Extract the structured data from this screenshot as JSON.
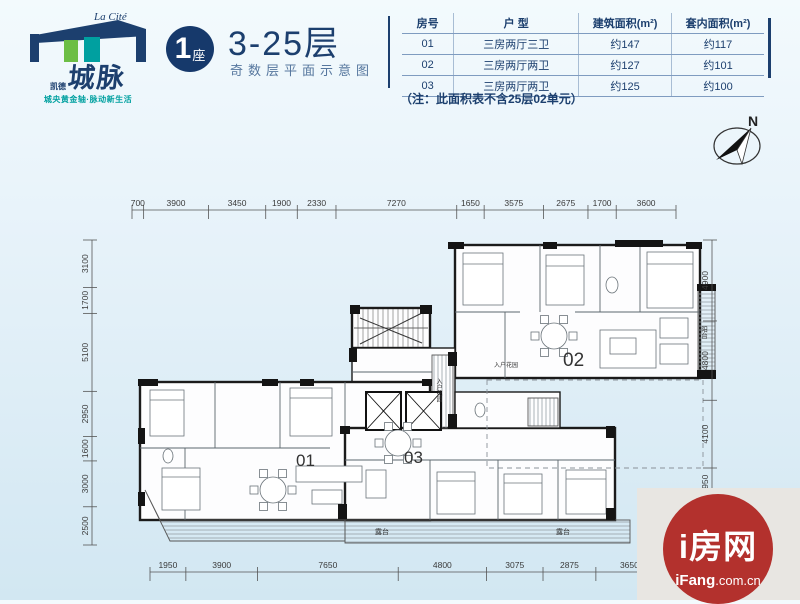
{
  "logo": {
    "brand_en": "La Cité",
    "brand_cn_small": "凯德",
    "brand_cn_big": "城脉",
    "tagline": "城央黄金轴·脉动新生活",
    "colors": {
      "navy": "#1c3f6e",
      "green": "#6cbe45",
      "teal": "#00a0a0"
    }
  },
  "header": {
    "block_number": "1",
    "block_suffix": "座",
    "title": "3-25层",
    "subtitle": "奇数层平面示意图"
  },
  "area_table": {
    "headers": [
      "房号",
      "户  型",
      "建筑面积(m²)",
      "套内面积(m²)"
    ],
    "rows": [
      [
        "01",
        "三房两厅三卫",
        "约147",
        "约117"
      ],
      [
        "02",
        "三房两厅两卫",
        "约127",
        "约101"
      ],
      [
        "03",
        "三房两厅两卫",
        "约125",
        "约100"
      ]
    ],
    "note": "（注：此面积表不含25层02单元）"
  },
  "compass": {
    "label": "N"
  },
  "floor_plan": {
    "unit_labels": [
      "01",
      "02",
      "03"
    ],
    "room_labels": {
      "terrace": "露台",
      "balcony": "阳台",
      "entry_garden": "入户花园"
    },
    "dimensions": {
      "top": [
        700,
        3900,
        3450,
        1900,
        2330,
        7270,
        1650,
        3575,
        2675,
        1700,
        3600
      ],
      "bottom": [
        1950,
        3900,
        7650,
        4800,
        3075,
        2875,
        3650,
        1850
      ],
      "left": [
        3100,
        1700,
        5100,
        2950,
        1600,
        3000,
        2500
      ],
      "right": [
        4900,
        4800,
        4100,
        1950,
        1500
      ]
    }
  },
  "watermark": {
    "logo_text": "i房网",
    "domain_bold": "iFang",
    "domain_rest": ".com.cn"
  }
}
